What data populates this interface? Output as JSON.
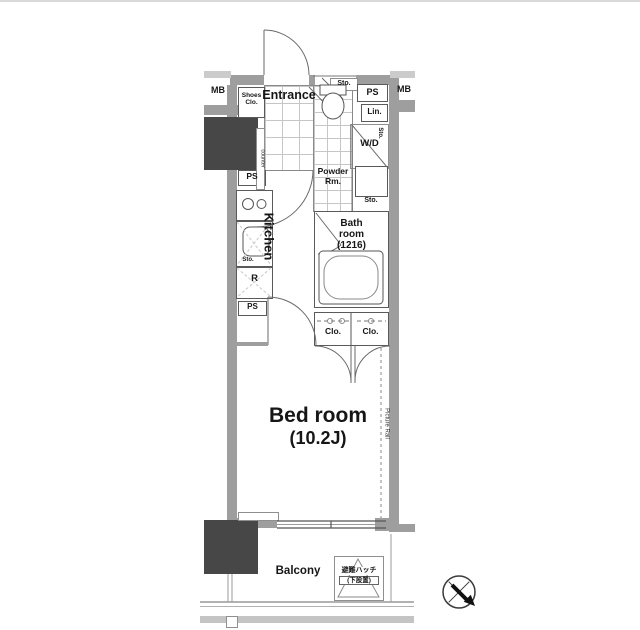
{
  "page": {
    "background": "#ffffff",
    "frame_line_color": "#dadada"
  },
  "colors": {
    "wall": "#9e9e9e",
    "wall_light": "#cbcbcb",
    "shaft_dark": "#474747",
    "line": "#5a5a5a",
    "tile_line": "#c6c6c6",
    "text": "#161616"
  },
  "plan": {
    "meter_box_left": "MB",
    "meter_box_right": "MB",
    "shoes_closet": [
      "Shoes",
      "Clo."
    ],
    "entrance": "Entrance",
    "storage_toilet": "Sto.",
    "pipe_space_top": "PS",
    "linen": "Lin.",
    "washer_dryer": "W/D",
    "storage_wd": "Sto.",
    "powder_room": [
      "Powder",
      "Rm."
    ],
    "storage_powder": "Sto.",
    "bathroom": [
      "Bath",
      "room",
      "(1216)"
    ],
    "closet_left": "Clo.",
    "closet_right": "Clo.",
    "counter": "counter",
    "kitchen": "Kitchen",
    "storage_kitchen": "Sto.",
    "refrigerator": "R",
    "pipe_space_kitchen_top": "PS",
    "pipe_space_kitchen_bottom": "PS",
    "bedroom_name": "Bed room",
    "bedroom_size": "(10.2J)",
    "picture_rail": "Picture Rail",
    "balcony": "Balcony",
    "evacuation_hatch": [
      "避難ハッチ",
      "(下設置)"
    ]
  }
}
